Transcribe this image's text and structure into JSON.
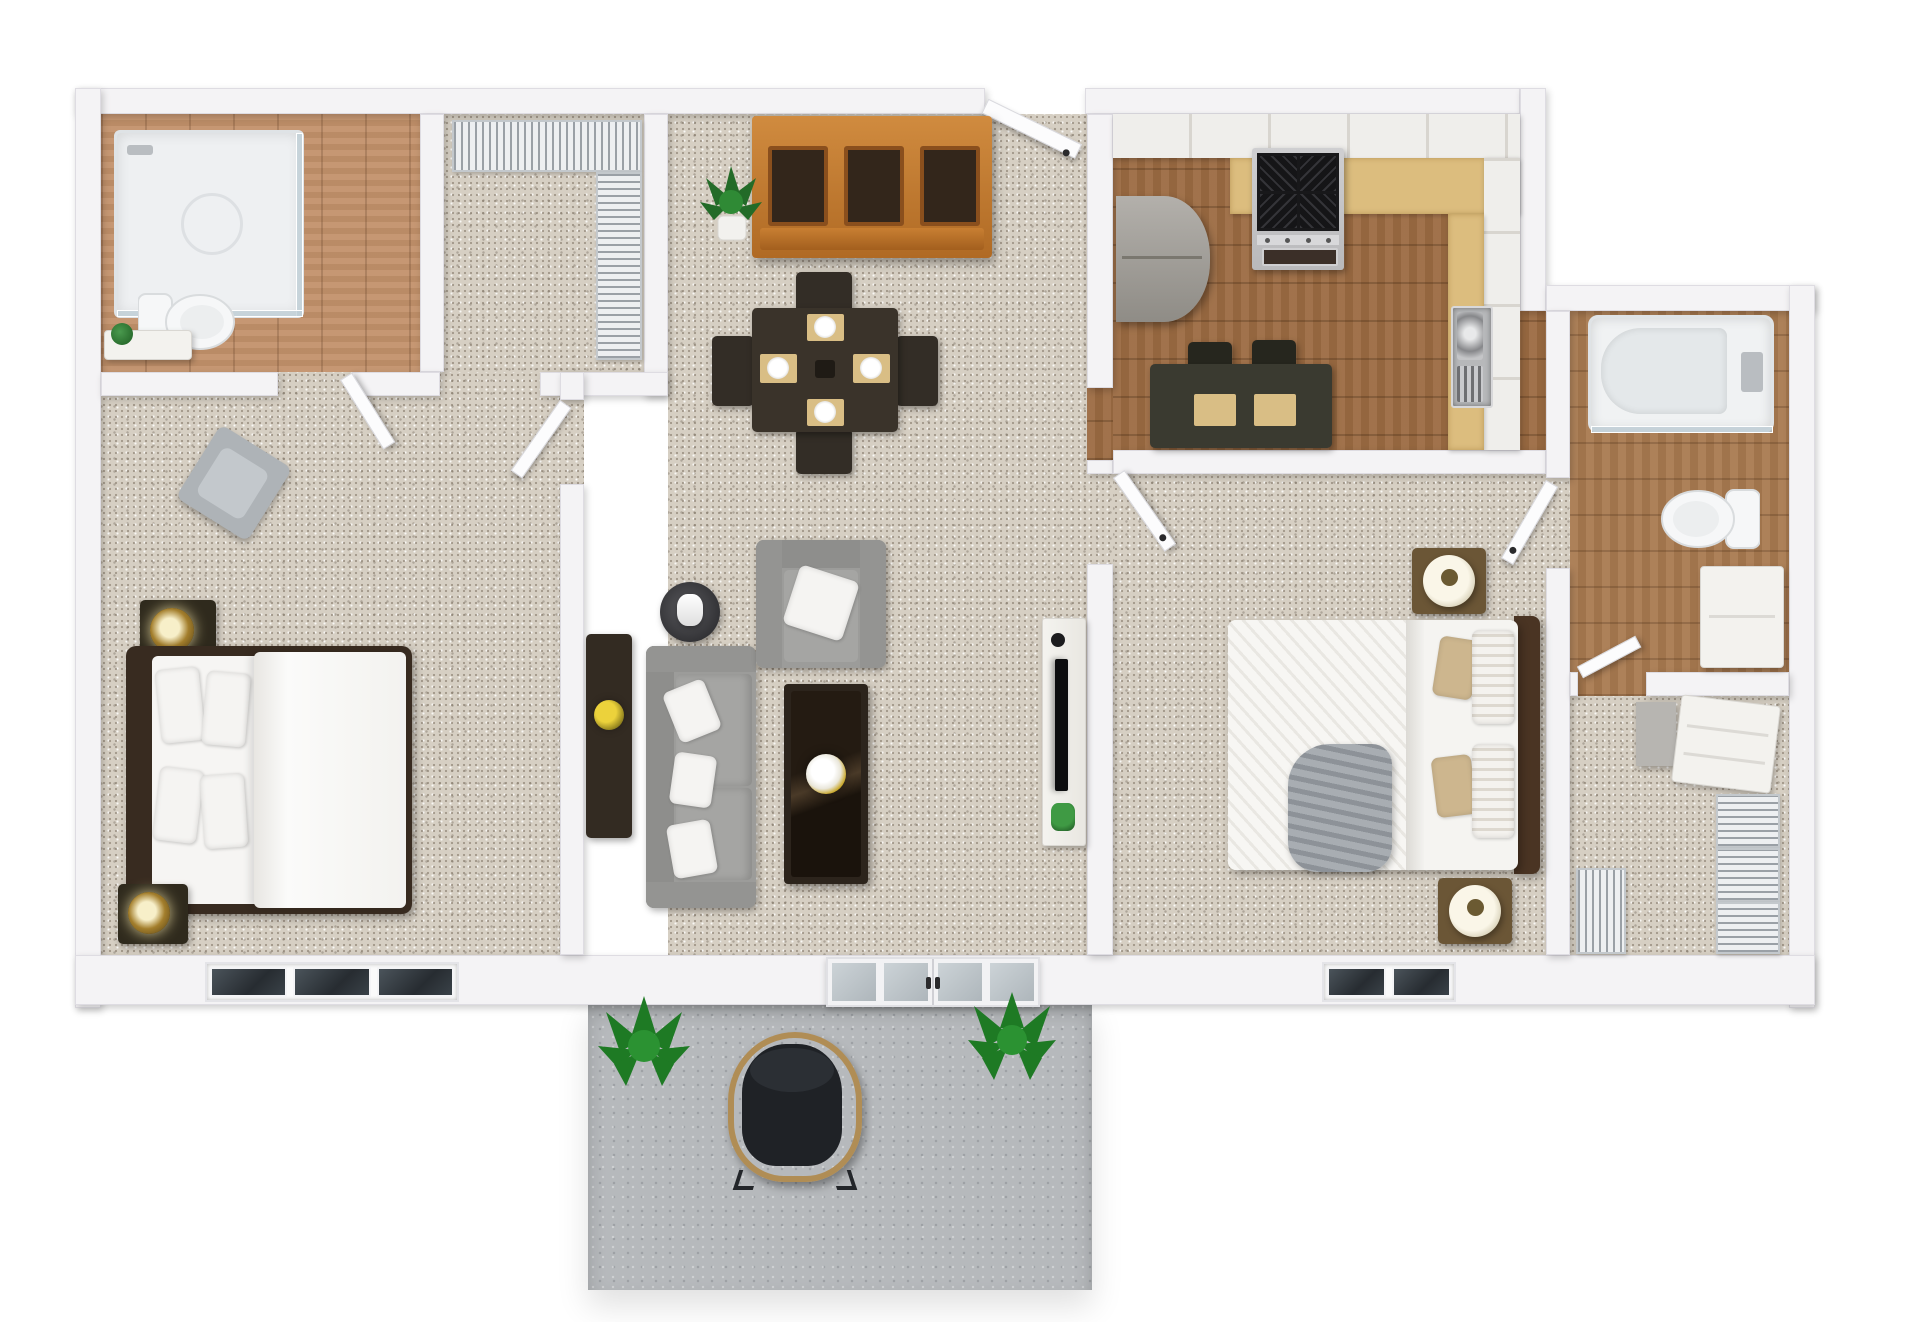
{
  "meta": {
    "title": "3D rendered top-down floor plan of a two-bedroom two-bathroom apartment with patio",
    "render_style": "photoreal dollhouse top view, no text labels"
  },
  "palette": {
    "background": "#ffffff",
    "wall": "#f4f3f5",
    "carpet": "#d6cfc3",
    "wood_bathroom1": "#c2916a",
    "wood_kitchen": "#9c6b42",
    "wood_bathroom2": "#a97a50",
    "patio_concrete": "#b6b9bc",
    "hutch_wood": "#c07c30",
    "dark_furniture": "#3a332b",
    "sofa_gray": "#9c9c9a",
    "countertop_tan": "#dcbd7e",
    "appliance_steel": "#c6c7c9",
    "stove_grate": "#1b1b1d",
    "lamp_gold": "#a37e2c",
    "throw_gray": "#9da3a8",
    "plant_green": "#2f7d33",
    "placemat_tan": "#d9be85"
  },
  "rooms": [
    {
      "id": "bathroom-1",
      "name": "Bathroom 1 (top left)",
      "floor": "wood",
      "furniture": [
        "glass corner shower",
        "toilet",
        "small vanity with plant"
      ]
    },
    {
      "id": "closet-1",
      "name": "Hall closet with wire shelving",
      "floor": "carpet",
      "furniture": [
        "wire shelf top",
        "wire shelf side"
      ]
    },
    {
      "id": "bedroom-1",
      "name": "Bedroom 1 (left)",
      "floor": "carpet",
      "furniture": [
        "double bed with white duvet and four pillows",
        "nightstand with gold lamp (top)",
        "nightstand with gold lamp (bottom)",
        "gray accent chair",
        "three-pane window"
      ]
    },
    {
      "id": "dining-living",
      "name": "Dining and living room (center)",
      "floor": "carpet",
      "furniture": [
        "wooden hutch cabinet",
        "potted plant",
        "dining table with four place settings",
        "four dining chairs",
        "dark sideboard with yellow flowers",
        "floor lamp",
        "gray sofa with three white pillows",
        "gray armchair with white pillow",
        "dark coffee table with flower vase",
        "white media console with TV, speaker and plant",
        "open entry door",
        "french doors to patio"
      ]
    },
    {
      "id": "kitchen",
      "name": "Kitchen (top right)",
      "floor": "wood",
      "furniture": [
        "white upper cabinets",
        "tan countertops",
        "refrigerator",
        "gas range with four burners",
        "stainless sink with drainboard",
        "breakfast table with two placemats and two chairs"
      ]
    },
    {
      "id": "bedroom-2",
      "name": "Bedroom 2 (right)",
      "floor": "carpet",
      "furniture": [
        "double bed with striped duvet, tan pillows and gray throw",
        "nightstand with white drum lamp (top)",
        "nightstand with white drum lamp (bottom)",
        "two-pane window",
        "two open doors"
      ]
    },
    {
      "id": "bathroom-2",
      "name": "Bathroom 2 (far right)",
      "floor": "wood",
      "furniture": [
        "tub shower with glass front",
        "toilet",
        "white vanity cabinet"
      ]
    },
    {
      "id": "closet-2",
      "name": "Walk-in closet (far right bottom)",
      "floor": "carpet",
      "furniture": [
        "white dresser",
        "gray cabinet",
        "wire shelving units"
      ]
    }
  ],
  "patio": {
    "name": "Patio (bottom center)",
    "floor": "concrete",
    "furniture": [
      "black wicker lounge chair",
      "potted plant left",
      "potted plant right"
    ]
  }
}
